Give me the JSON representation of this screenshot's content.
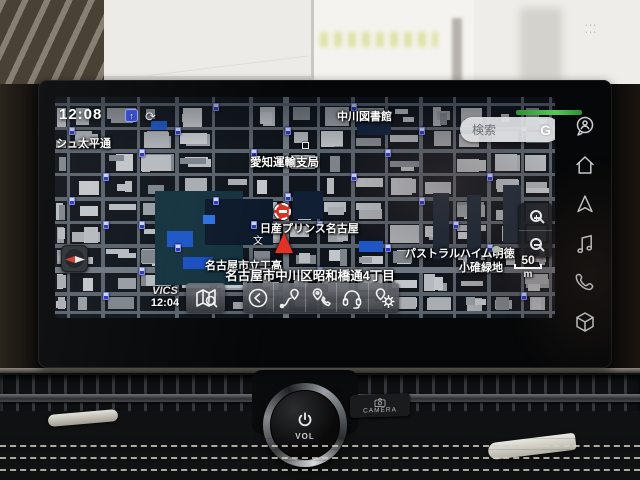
{
  "screen": {
    "clock": "12:08",
    "status_icons": [
      "upload-icon",
      "sync-icon"
    ],
    "search": {
      "placeholder": "検索",
      "logo_letter": "G"
    },
    "map": {
      "labels": {
        "street_left": "ッシュ太平通",
        "transport_office": "愛知運輸支局",
        "hall_north": "中川図書館",
        "dealer": "日産プリンス名古屋",
        "apartment": "パストラルハイム明徳",
        "school": "名古屋市立工高",
        "school_symbol": "文",
        "park": "小碓緑地"
      },
      "current_address": "名古屋市中川区昭和橋通4丁目",
      "vics": {
        "label": "VICS",
        "time": "12:04"
      },
      "scale": {
        "value": "50",
        "unit": "m"
      }
    },
    "toolbar_icons": [
      "map-search-icon",
      "back-icon",
      "location-arrow-icon",
      "pin-phone-icon",
      "headset-icon",
      "pin-gear-icon"
    ],
    "sidebar_icons": [
      "voice-assistant-icon",
      "home-icon",
      "map-icon",
      "audio-icon",
      "phone-icon",
      "apps-icon"
    ],
    "accent_colors": {
      "traffic_icon_blue": "#2a37c2",
      "highlight_building_blue": "#1d56c8",
      "status_green": "#57c957",
      "position_red": "#e23227"
    }
  },
  "dashboard": {
    "volume_knob_label": "VOL",
    "camera_button_label": "CAMERA"
  }
}
